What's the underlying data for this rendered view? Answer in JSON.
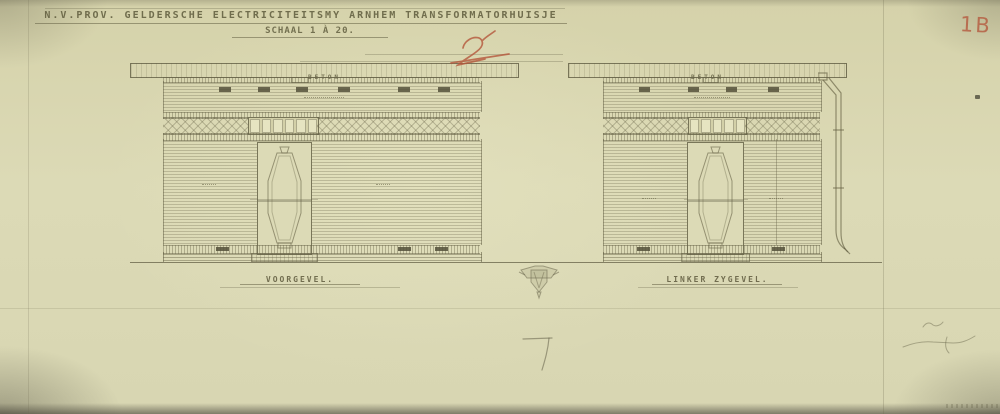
{
  "drawing": {
    "title": "N.V.PROV. GELDERSCHE ELECTRICITEITSMY ARNHEM TRANSFORMATORHUISJE",
    "scale_label": "SCHAAL 1 À 20.",
    "elevations": [
      {
        "id": "voorgevel",
        "caption": "VOORGEVEL.",
        "roof_label": "BETON"
      },
      {
        "id": "linker-zygevel",
        "caption": "LINKER ZYGEVEL.",
        "roof_label": "BETON"
      }
    ],
    "marks": {
      "sheet_number_red": "1B",
      "revision_red": "2"
    },
    "colors": {
      "paper": "#dcdab6",
      "ink": "#65614a",
      "red_pencil": "#b5573c"
    }
  }
}
